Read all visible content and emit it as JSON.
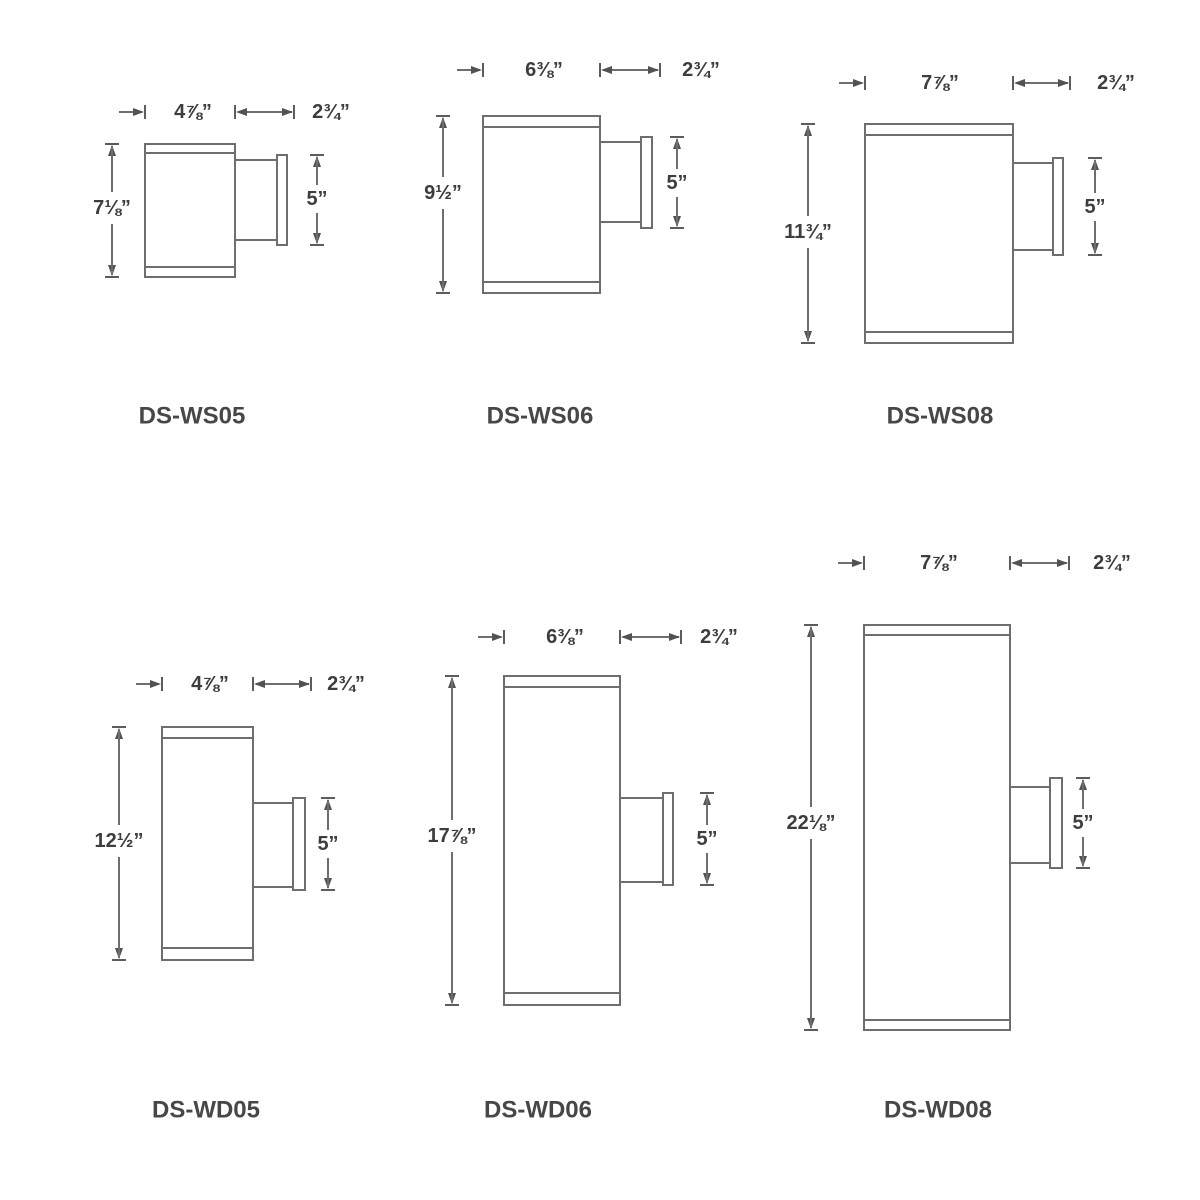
{
  "colors": {
    "background": "#ffffff",
    "line": "#6e6e6e",
    "arrow": "#525252",
    "text": "#3d3d3d"
  },
  "fixtures": [
    {
      "model": "DS-WS05",
      "labels": {
        "width": "4⅞”",
        "depth": "2¾”",
        "height": "7⅛”",
        "plate": "5”"
      },
      "geom": {
        "body": [
          145,
          144,
          90,
          133
        ],
        "caps": [
          153,
          267
        ],
        "arm": [
          235,
          160,
          42,
          80
        ],
        "plate": [
          277,
          155,
          10,
          90
        ],
        "dims": {
          "width_y": 112,
          "stub_left": 119,
          "seg_end": 294,
          "label_a_x": 193,
          "label_b_x": 331,
          "height_x": 112,
          "height_label_y": 208,
          "plate_x": 317,
          "plate_label_y": 199
        },
        "model_pos": [
          192,
          416
        ]
      }
    },
    {
      "model": "DS-WS06",
      "labels": {
        "width": "6⅜”",
        "depth": "2¾”",
        "height": "9½”",
        "plate": "5”"
      },
      "geom": {
        "body": [
          483,
          116,
          117,
          177
        ],
        "caps": [
          127,
          282
        ],
        "arm": [
          600,
          142,
          41,
          80
        ],
        "plate": [
          641,
          137,
          11,
          91
        ],
        "dims": {
          "width_y": 70,
          "stub_left": 457,
          "seg_end": 660,
          "label_a_x": 544,
          "label_b_x": 701,
          "height_x": 443,
          "height_label_y": 193,
          "plate_x": 677,
          "plate_label_y": 183
        },
        "model_pos": [
          540,
          416
        ]
      }
    },
    {
      "model": "DS-WS08",
      "labels": {
        "width": "7⅞”",
        "depth": "2¾”",
        "height": "11¾”",
        "plate": "5”"
      },
      "geom": {
        "body": [
          865,
          124,
          148,
          219
        ],
        "caps": [
          135,
          332
        ],
        "arm": [
          1013,
          163,
          40,
          87
        ],
        "plate": [
          1053,
          158,
          10,
          97
        ],
        "dims": {
          "width_y": 83,
          "stub_left": 839,
          "seg_end": 1070,
          "label_a_x": 940,
          "label_b_x": 1116,
          "height_x": 808,
          "height_label_y": 232,
          "plate_x": 1095,
          "plate_label_y": 207
        },
        "model_pos": [
          940,
          416
        ]
      }
    },
    {
      "model": "DS-WD05",
      "labels": {
        "width": "4⅞”",
        "depth": "2¾”",
        "height": "12½”",
        "plate": "5”"
      },
      "geom": {
        "body": [
          162,
          727,
          91,
          233
        ],
        "caps": [
          738,
          948
        ],
        "arm": [
          253,
          803,
          40,
          84
        ],
        "plate": [
          293,
          798,
          12,
          92
        ],
        "dims": {
          "width_y": 684,
          "stub_left": 136,
          "seg_end": 311,
          "label_a_x": 210,
          "label_b_x": 346,
          "height_x": 119,
          "height_label_y": 841,
          "plate_x": 328,
          "plate_label_y": 844
        },
        "model_pos": [
          206,
          1110
        ]
      }
    },
    {
      "model": "DS-WD06",
      "labels": {
        "width": "6⅜”",
        "depth": "2¾”",
        "height": "17⅞”",
        "plate": "5”"
      },
      "geom": {
        "body": [
          504,
          676,
          116,
          329
        ],
        "caps": [
          687,
          993
        ],
        "arm": [
          620,
          798,
          43,
          84
        ],
        "plate": [
          663,
          793,
          10,
          92
        ],
        "dims": {
          "width_y": 637,
          "stub_left": 478,
          "seg_end": 681,
          "label_a_x": 565,
          "label_b_x": 719,
          "height_x": 452,
          "height_label_y": 836,
          "plate_x": 707,
          "plate_label_y": 839
        },
        "model_pos": [
          538,
          1110
        ]
      }
    },
    {
      "model": "DS-WD08",
      "labels": {
        "width": "7⅞”",
        "depth": "2¾”",
        "height": "22⅛”",
        "plate": "5”"
      },
      "geom": {
        "body": [
          864,
          625,
          146,
          405
        ],
        "caps": [
          635,
          1020
        ],
        "arm": [
          1010,
          787,
          40,
          76
        ],
        "plate": [
          1050,
          778,
          12,
          90
        ],
        "dims": {
          "width_y": 563,
          "stub_left": 838,
          "seg_end": 1069,
          "label_a_x": 939,
          "label_b_x": 1112,
          "height_x": 811,
          "height_label_y": 823,
          "plate_x": 1083,
          "plate_label_y": 823
        },
        "model_pos": [
          938,
          1110
        ]
      }
    }
  ]
}
